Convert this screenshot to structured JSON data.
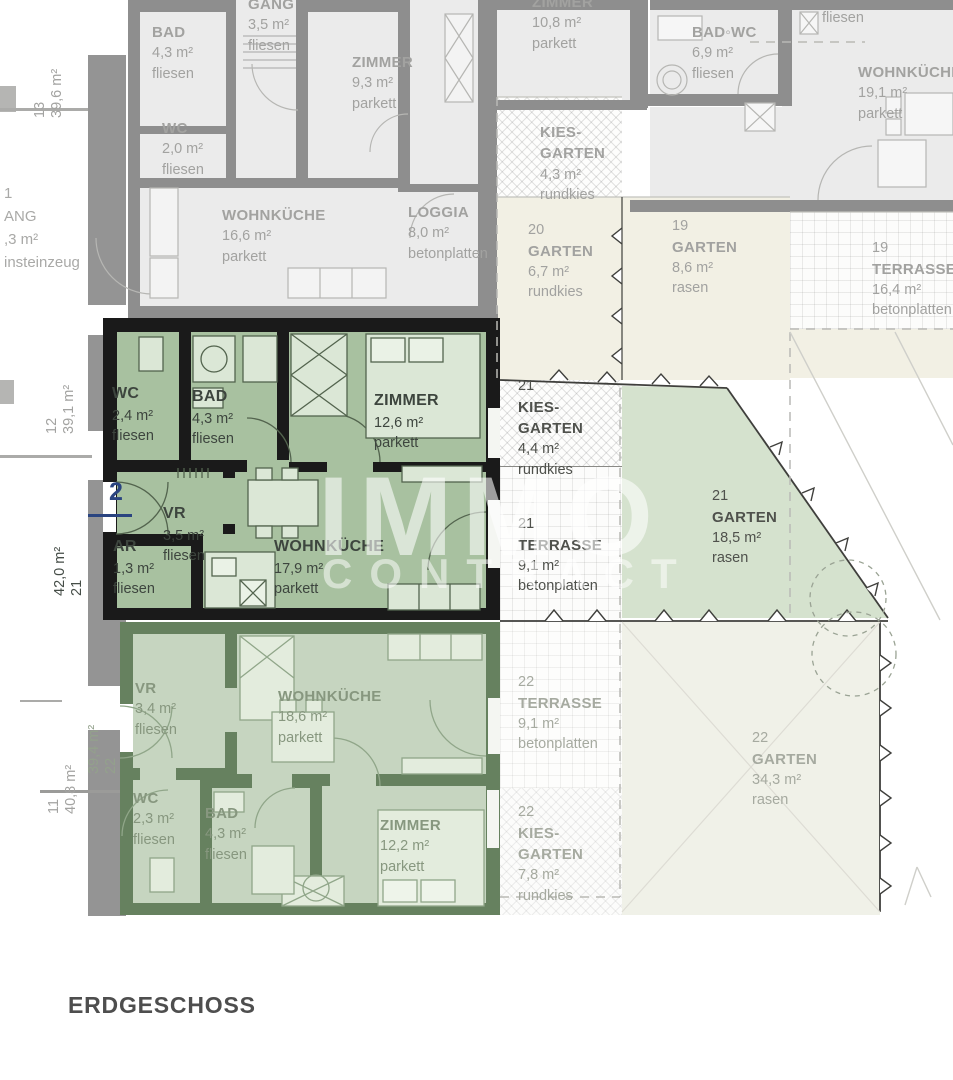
{
  "floor_plan": {
    "floor_label": "ERDGESCHOSS",
    "watermark": {
      "line1": "IMMO",
      "line2": "CONTRACT"
    },
    "entrance_marker": "2",
    "margin_labels": {
      "u13": {
        "col1": "13",
        "col2": "39,6 m²"
      },
      "u12": {
        "col1": "12",
        "col2": "39,1 m²"
      },
      "u21": {
        "col1": "42,0 m²",
        "col2": "21"
      },
      "u11": {
        "col1": "11",
        "col2": "40,8 m²"
      },
      "u22": {
        "col1": "39,4 m²",
        "col2": "22"
      }
    },
    "corridor_fragment": {
      "lines": "1\nANG\n,3 m²\ninsteinzeug"
    },
    "rooms_top": {
      "bad": {
        "name": "BAD",
        "area": "4,3 m²",
        "floor": "fliesen"
      },
      "gang": {
        "name": "GANG",
        "area": "3,5 m²",
        "floor": "fliesen"
      },
      "wc": {
        "name": "WC",
        "area": "2,0 m²",
        "floor": "fliesen"
      },
      "zimmer": {
        "name": "ZIMMER",
        "area": "9,3 m²",
        "floor": "parkett"
      },
      "wohnkueche": {
        "name": "WOHNKÜCHE",
        "area": "16,6 m²",
        "floor": "parkett"
      },
      "loggia": {
        "name": "LOGGIA",
        "area": "8,0 m²",
        "floor": "betonplatten"
      },
      "zimmer2": {
        "name": "ZIMMER",
        "area": "10,8 m²",
        "floor": "parkett"
      },
      "badwc": {
        "name": "BAD◦WC",
        "area": "6,9 m²",
        "floor": "fliesen"
      },
      "fliesen_fragment": "fliesen",
      "wohnkueche2": {
        "name": "WOHNKÜCHE",
        "area": "19,1 m²",
        "floor": "parkett"
      },
      "kiesgarten": {
        "name": "KIES-\nGARTEN",
        "area": "4,3 m²",
        "floor": "rundkies"
      },
      "garten20": {
        "number": "20",
        "name": "GARTEN",
        "area": "6,7 m²",
        "floor": "rundkies"
      },
      "garten19": {
        "number": "19",
        "name": "GARTEN",
        "area": "8,6 m²",
        "floor": "rasen"
      },
      "terrasse19": {
        "number": "19",
        "name": "TERRASSE",
        "area": "16,4 m²",
        "floor": "betonplatten"
      }
    },
    "unit21": {
      "wc": {
        "name": "WC",
        "area": "2,4 m²",
        "floor": "fliesen"
      },
      "bad": {
        "name": "BAD",
        "area": "4,3 m²",
        "floor": "fliesen"
      },
      "zimmer": {
        "name": "ZIMMER",
        "area": "12,6 m²",
        "floor": "parkett"
      },
      "vr": {
        "name": "VR",
        "area": "3,5 m²",
        "floor": "fliesen"
      },
      "ar": {
        "name": "AR",
        "area": "1,3 m²",
        "floor": "fliesen"
      },
      "wohnkueche": {
        "name": "WOHNKÜCHE",
        "area": "17,9 m²",
        "floor": "parkett"
      },
      "kiesgarten": {
        "number": "21",
        "name": "KIES-\nGARTEN",
        "area": "4,4 m²",
        "floor": "rundkies"
      },
      "terrasse": {
        "number": "21",
        "name": "TERRASSE",
        "area": "9,1 m²",
        "floor": "betonplatten"
      },
      "garten": {
        "number": "21",
        "name": "GARTEN",
        "area": "18,5 m²",
        "floor": "rasen"
      }
    },
    "unit22": {
      "vr": {
        "name": "VR",
        "area": "3,4 m²",
        "floor": "fliesen"
      },
      "wohnkueche": {
        "name": "WOHNKÜCHE",
        "area": "18,6 m²",
        "floor": "parkett"
      },
      "wc": {
        "name": "WC",
        "area": "2,3 m²",
        "floor": "fliesen"
      },
      "bad": {
        "name": "BAD",
        "area": "4,3 m²",
        "floor": "fliesen"
      },
      "zimmer": {
        "name": "ZIMMER",
        "area": "12,2 m²",
        "floor": "parkett"
      },
      "terrasse": {
        "number": "22",
        "name": "TERRASSE",
        "area": "9,1 m²",
        "floor": "betonplatten"
      },
      "kiesgarten": {
        "number": "22",
        "name": "KIES-\nGARTEN",
        "area": "7,8 m²",
        "floor": "rundkies"
      },
      "garten": {
        "number": "22",
        "name": "GARTEN",
        "area": "34,3 m²",
        "floor": "rasen"
      }
    },
    "colors": {
      "unit_highlight_wall": "#1a1a1a",
      "unit_highlight_room": "#a8c1a0",
      "unit_dim_wall": "#66815f",
      "unit_dim_room": "#c6d5c0",
      "garden_green": "#d5e2ce",
      "garden_cream": "#f2f0e4",
      "gray_room": "#ebebeb",
      "gray_wall": "#8e8e8e",
      "marker_blue": "#2a4480"
    }
  }
}
